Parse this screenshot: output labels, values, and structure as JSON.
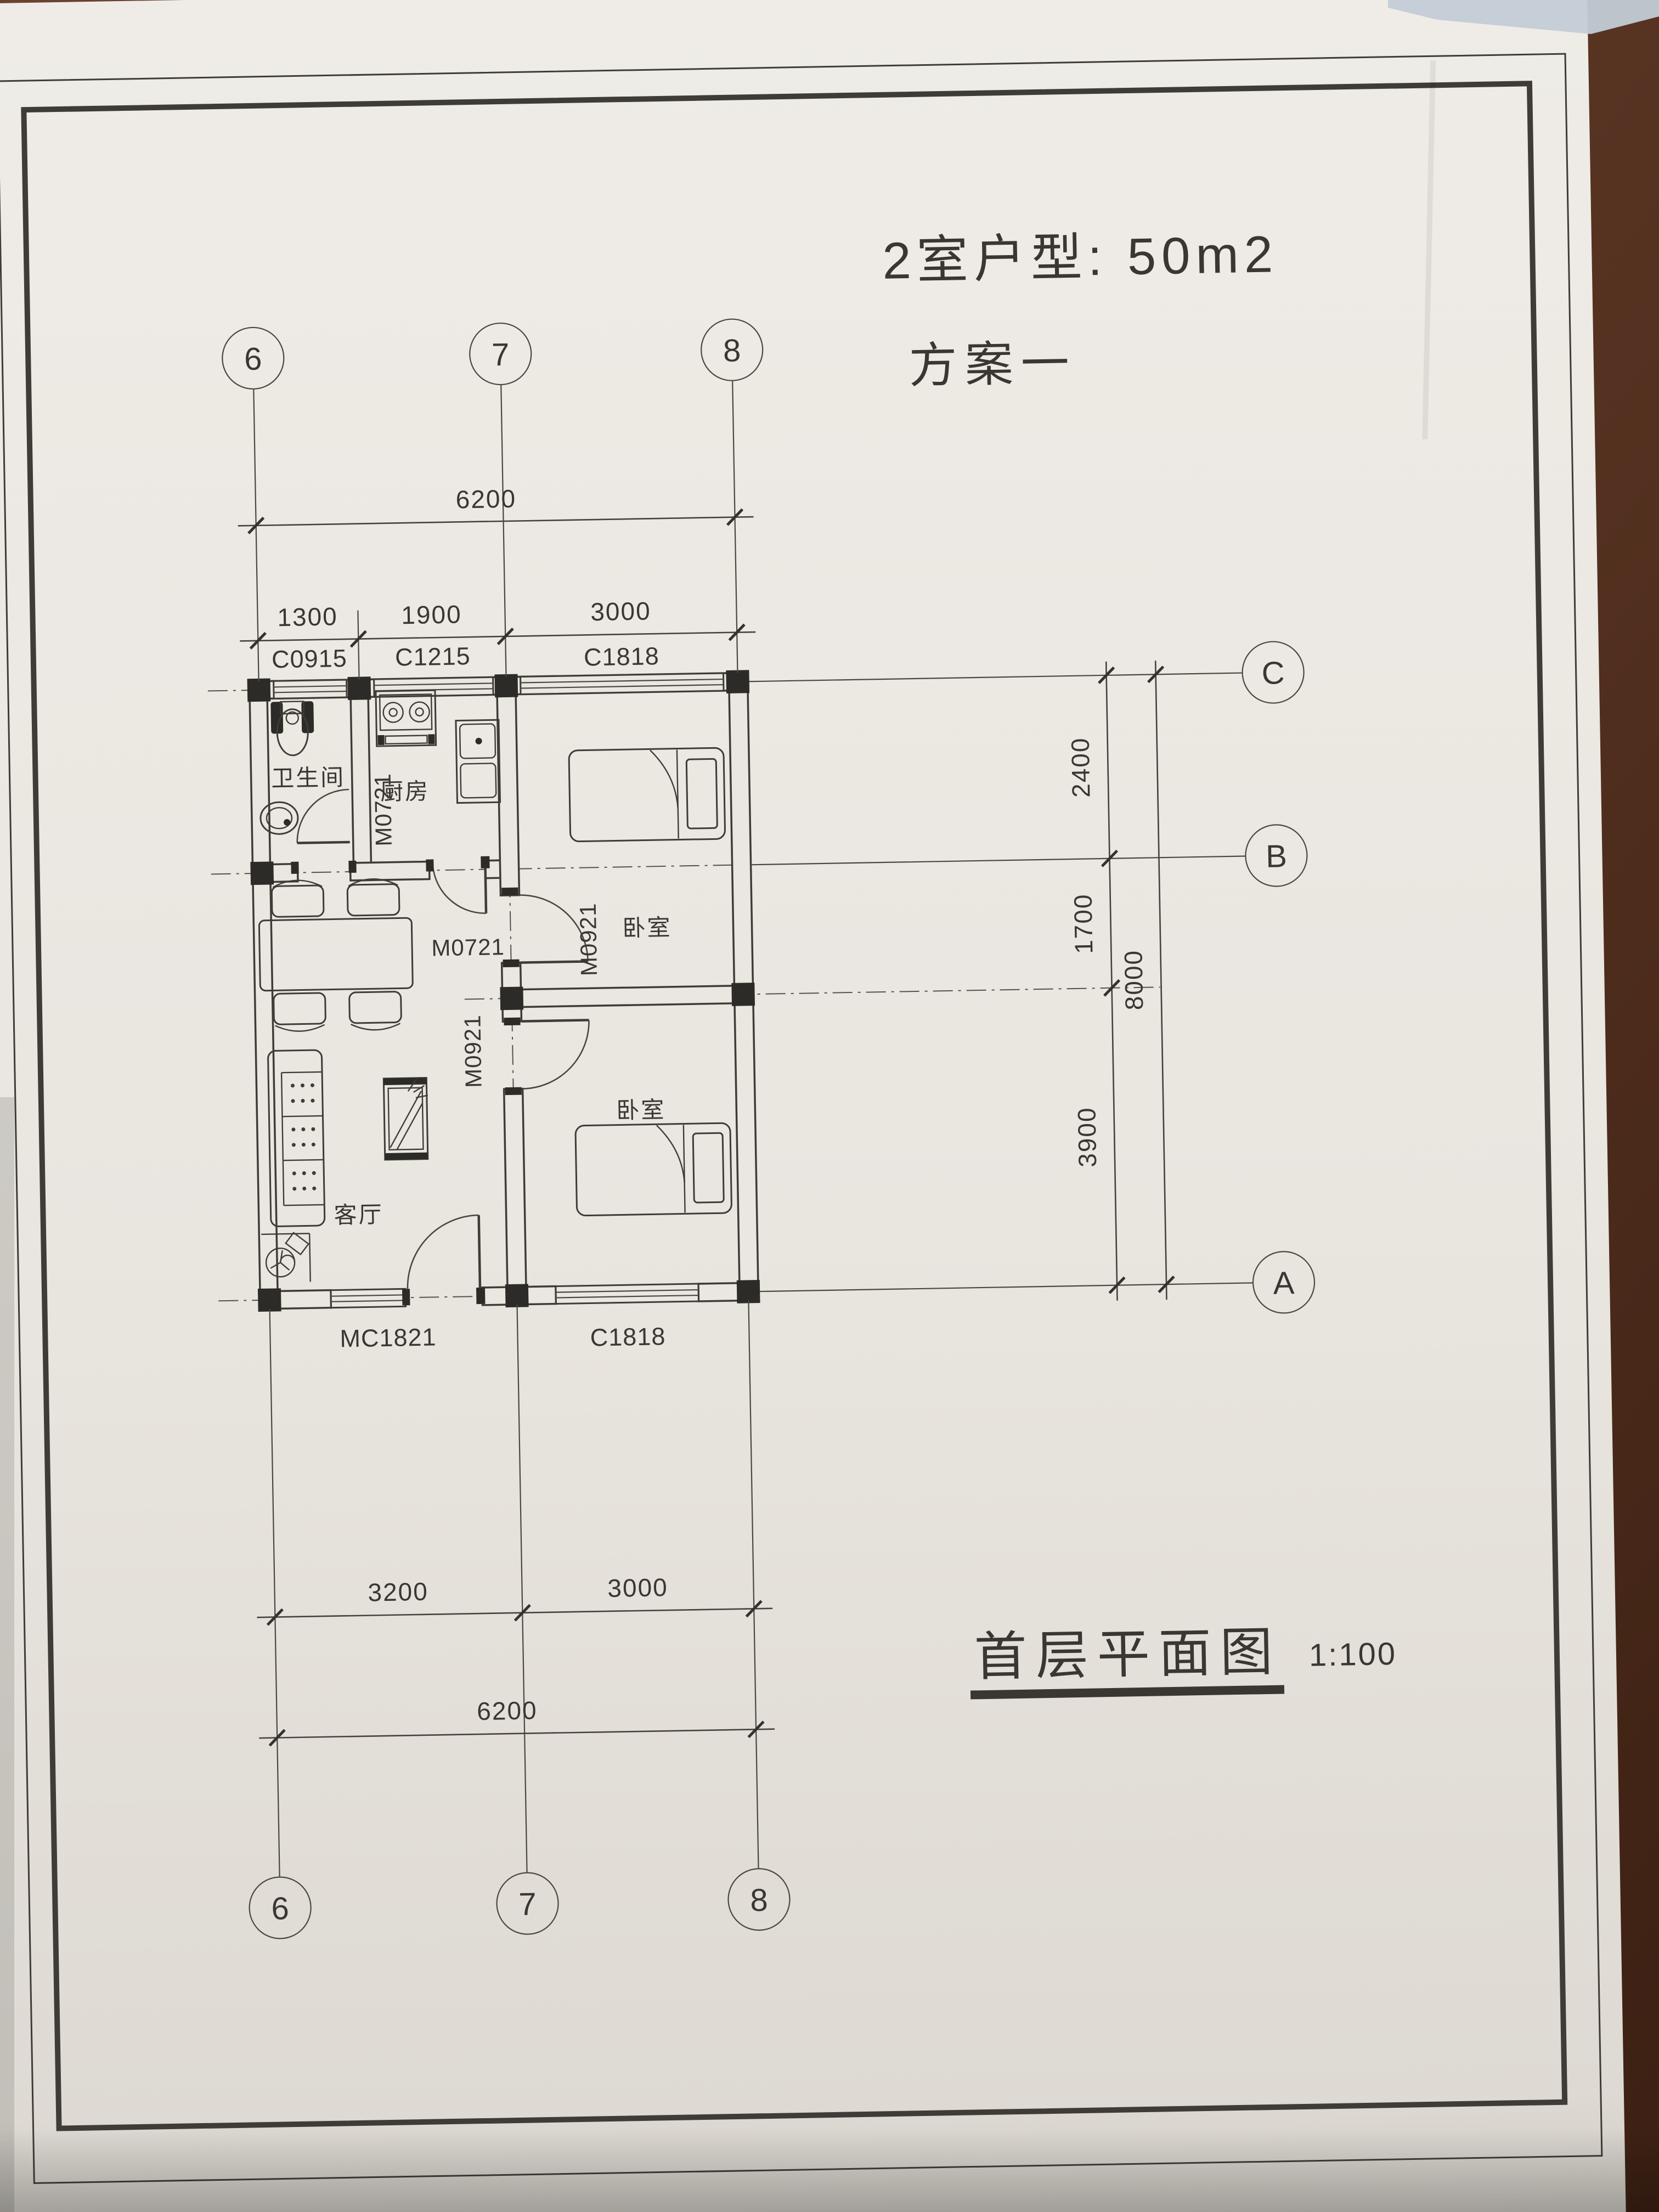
{
  "page": {
    "title_line1": "2室户型: 50m2",
    "title_line2": "方案一",
    "footer_title": "首层平面图",
    "footer_scale": "1:100"
  },
  "axes": {
    "top": [
      "6",
      "7",
      "8"
    ],
    "bottom": [
      "6",
      "7",
      "8"
    ],
    "right": [
      "C",
      "B",
      "A"
    ]
  },
  "dimensions": {
    "top_overall": "6200",
    "top_segments": [
      "1300",
      "1900",
      "3000"
    ],
    "bottom_segments": [
      "3200",
      "3000"
    ],
    "bottom_overall": "6200",
    "right_segments": [
      "2400",
      "1700",
      "3900"
    ],
    "right_overall": "8000"
  },
  "openings": {
    "window_top_bath": "C0915",
    "window_top_kitchen": "C1215",
    "window_top_bedroom": "C1818",
    "window_bottom_entry": "MC1821",
    "window_bottom_bedroom": "C1818",
    "door_bath": "M0721",
    "door_kitchen": "M0721",
    "door_bedroom1": "M0921",
    "door_bedroom2": "M0921"
  },
  "rooms": {
    "bathroom": "卫生间",
    "kitchen": "厨房",
    "bedroom1": "卧室",
    "bedroom2": "卧室",
    "living": "客厅"
  },
  "colors": {
    "paper": "#eae6e0",
    "ink": "#3f3c38",
    "wood": "#5d372a",
    "strip": "#c3ccd6"
  }
}
